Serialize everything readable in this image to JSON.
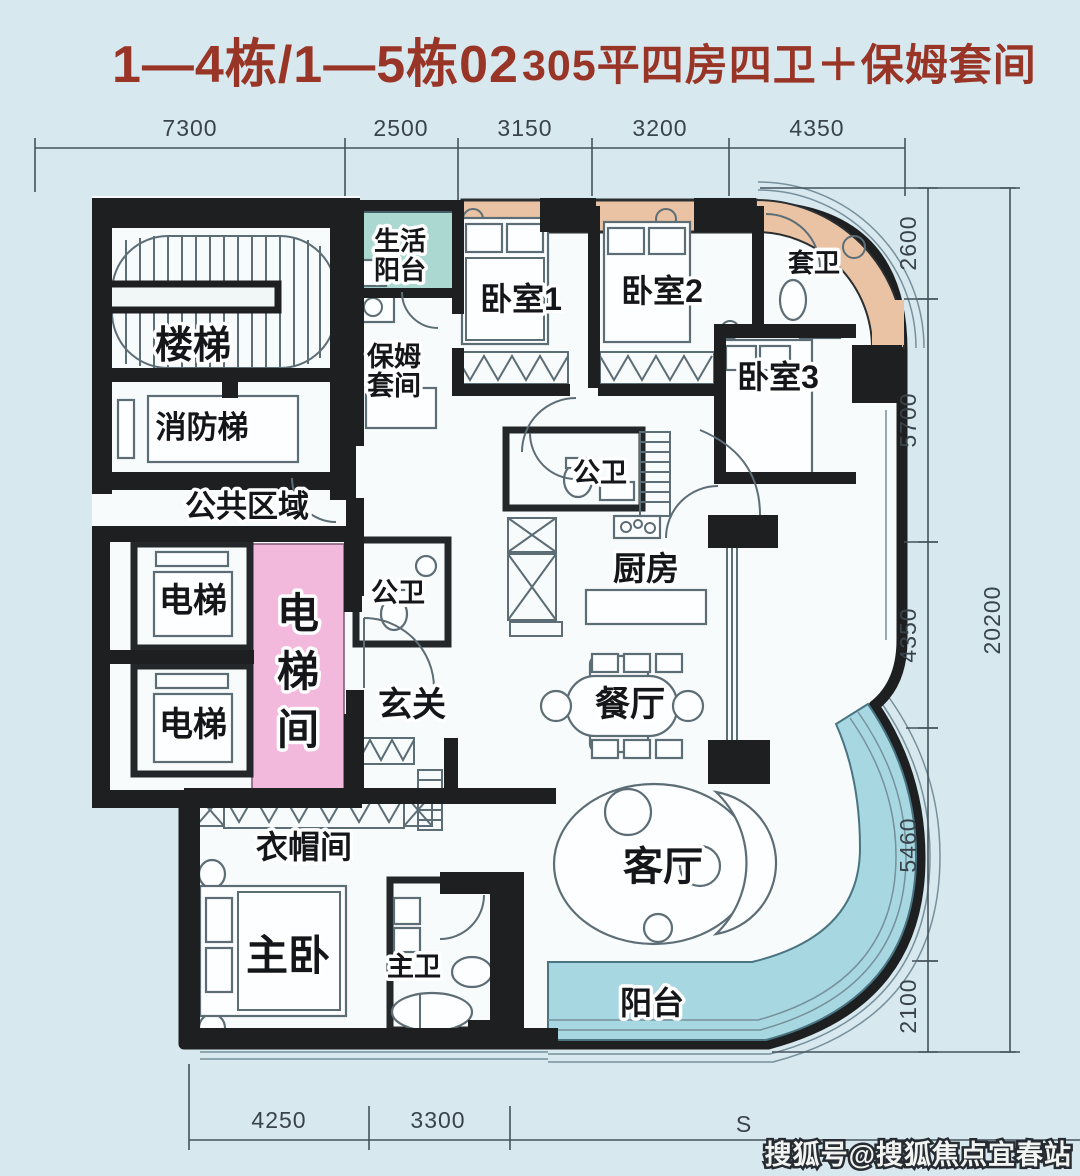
{
  "title": {
    "block_no": "1—4栋/1—5栋02",
    "spec": "305平四房四卫＋保姆套间"
  },
  "dims": {
    "top": [
      "7300",
      "2500",
      "3150",
      "3200",
      "4350"
    ],
    "right": [
      "2600",
      "5700",
      "4350",
      "5460",
      "2100"
    ],
    "right_total": "20200",
    "bottom": [
      "4250",
      "3300"
    ],
    "bottom_partial": "S"
  },
  "rooms": {
    "stairs": "楼梯",
    "fire_stairs": "消防梯",
    "public_area": "公共区域",
    "elevator_a": "电梯",
    "elevator_b": "电梯",
    "elevator_hall": "电梯间",
    "bath_west": "公卫",
    "foyer": "玄关",
    "cloakroom": "衣帽间",
    "master_bedroom": "主卧",
    "master_bath": "主卫",
    "life_balcony": [
      "生活",
      "阳台"
    ],
    "nanny_suite": [
      "保姆",
      "套间"
    ],
    "bedroom1": "卧室1",
    "bedroom2": "卧室2",
    "bedroom3": "卧室3",
    "suite_bath": "套卫",
    "bath_east": "公卫",
    "kitchen": "厨房",
    "dining": "餐厅",
    "living": "客厅",
    "balcony": "阳台"
  },
  "watermark": "搜狐号@搜狐焦点宜春站",
  "colors": {
    "background": "#d7e8ee",
    "floor": "#f7fbfb",
    "wall": "#1d1f21",
    "accent_red": "#993527",
    "elevator_hall_pink": "#f2b9dc",
    "life_balcony_teal": "#abd9d2",
    "bay_window_peach": "#e9c3a4",
    "balcony_blue": "#a7d8e2"
  }
}
